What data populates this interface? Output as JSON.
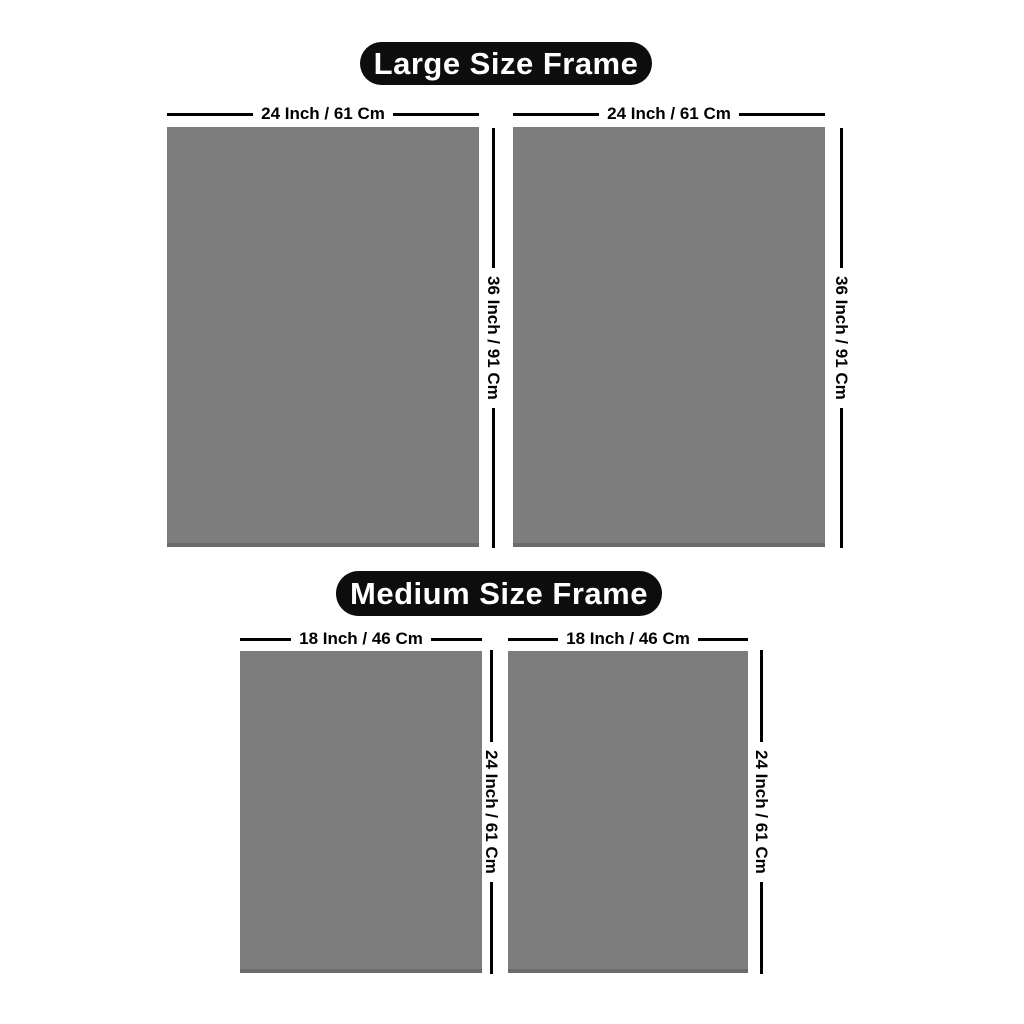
{
  "colors": {
    "frame_fill": "#7d7d7d",
    "frame_edge": "#6b6b6b",
    "dim_line": "#000000",
    "pill_bg": "#0d0d0d",
    "pill_text": "#ffffff",
    "label_text": "#000000",
    "page_bg": "#ffffff"
  },
  "sections": [
    {
      "title": "Large Size Frame",
      "frames": [
        {
          "width_label": "24 Inch / 61 Cm",
          "height_label": "36 Inch / 91 Cm"
        },
        {
          "width_label": "24 Inch / 61 Cm",
          "height_label": "36 Inch / 91 Cm"
        }
      ]
    },
    {
      "title": "Medium Size Frame",
      "frames": [
        {
          "width_label": "18 Inch / 46 Cm",
          "height_label": "24 Inch / 61 Cm"
        },
        {
          "width_label": "18 Inch / 46 Cm",
          "height_label": "24 Inch / 61 Cm"
        }
      ]
    }
  ]
}
